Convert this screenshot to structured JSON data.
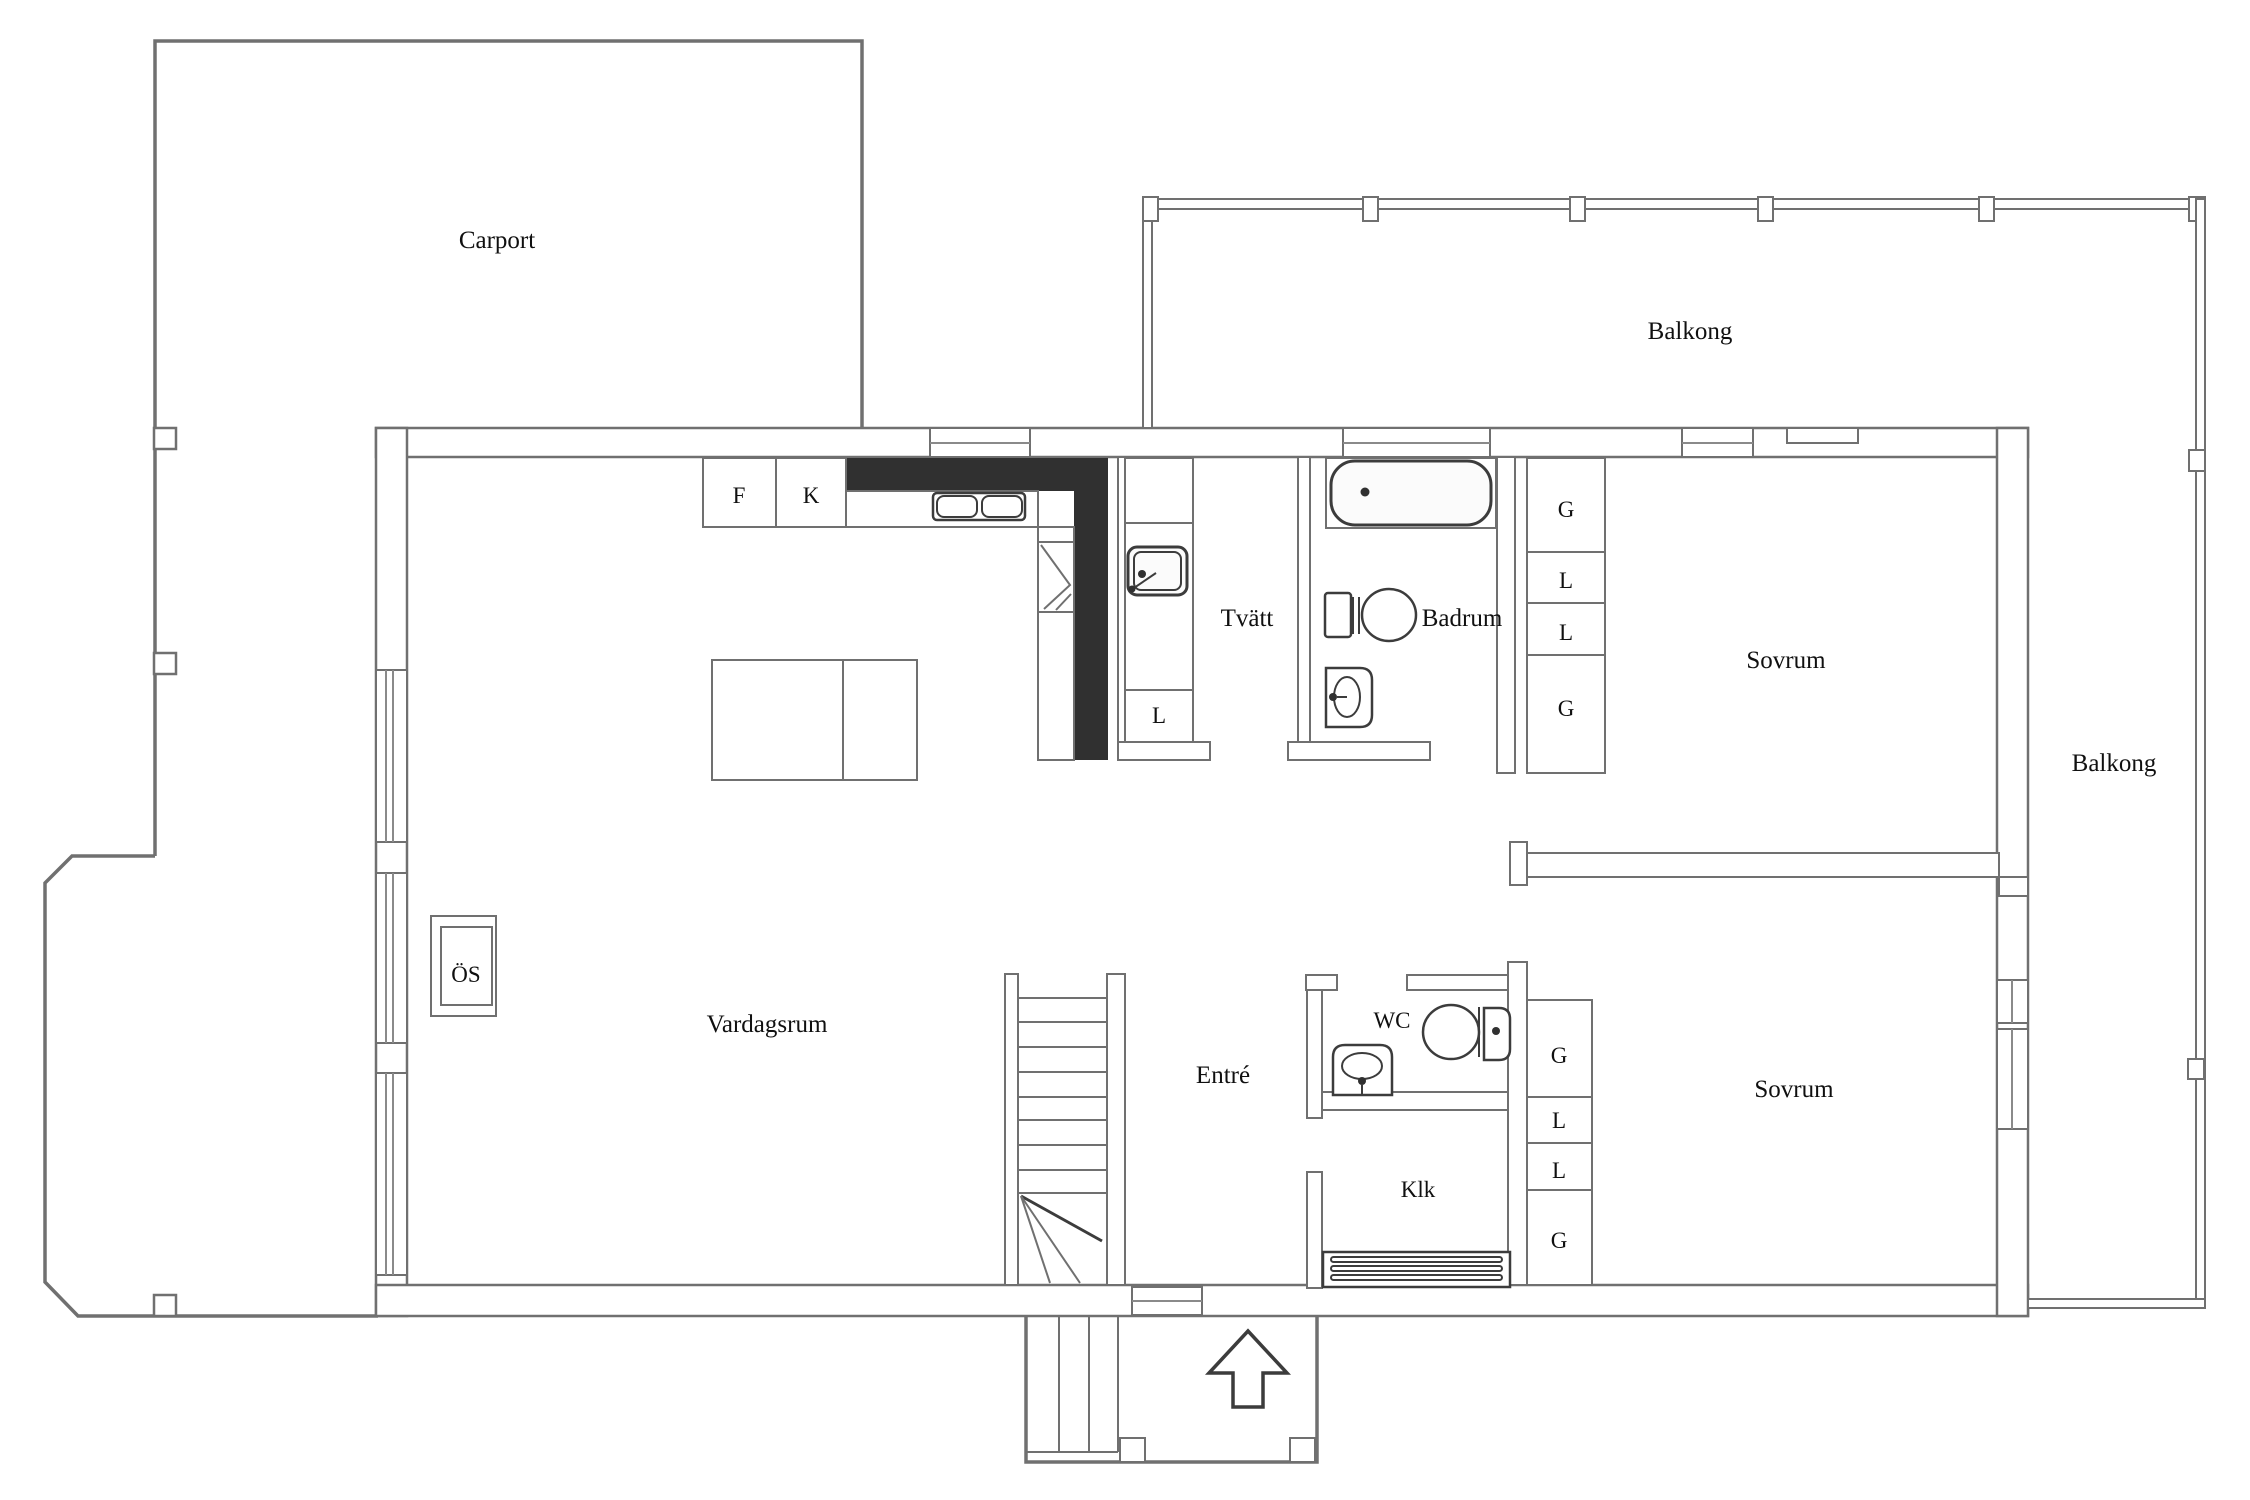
{
  "title": "Floor plan",
  "colors": {
    "background": "#ffffff",
    "wall_line": "#707070",
    "fixture_line": "#3c3c3c",
    "solid_wall": "#303030",
    "text": "#101010"
  },
  "rooms": [
    {
      "label": "Carport"
    },
    {
      "label": "Balkong"
    },
    {
      "label": "Tvätt"
    },
    {
      "label": "Badrum"
    },
    {
      "label": "Sovrum"
    },
    {
      "label": "Balkong"
    },
    {
      "label": "Vardagsrum"
    },
    {
      "label": "Entré"
    },
    {
      "label": "WC"
    },
    {
      "label": "Klk"
    },
    {
      "label": "Sovrum"
    }
  ],
  "fixtures": {
    "fridge": "F",
    "stove": "K",
    "fireplace": "ÖS",
    "laundry_cabinet": "L",
    "closets_upper": [
      "G",
      "L",
      "L",
      "G"
    ],
    "closets_lower": [
      "G",
      "L",
      "L",
      "G"
    ]
  }
}
